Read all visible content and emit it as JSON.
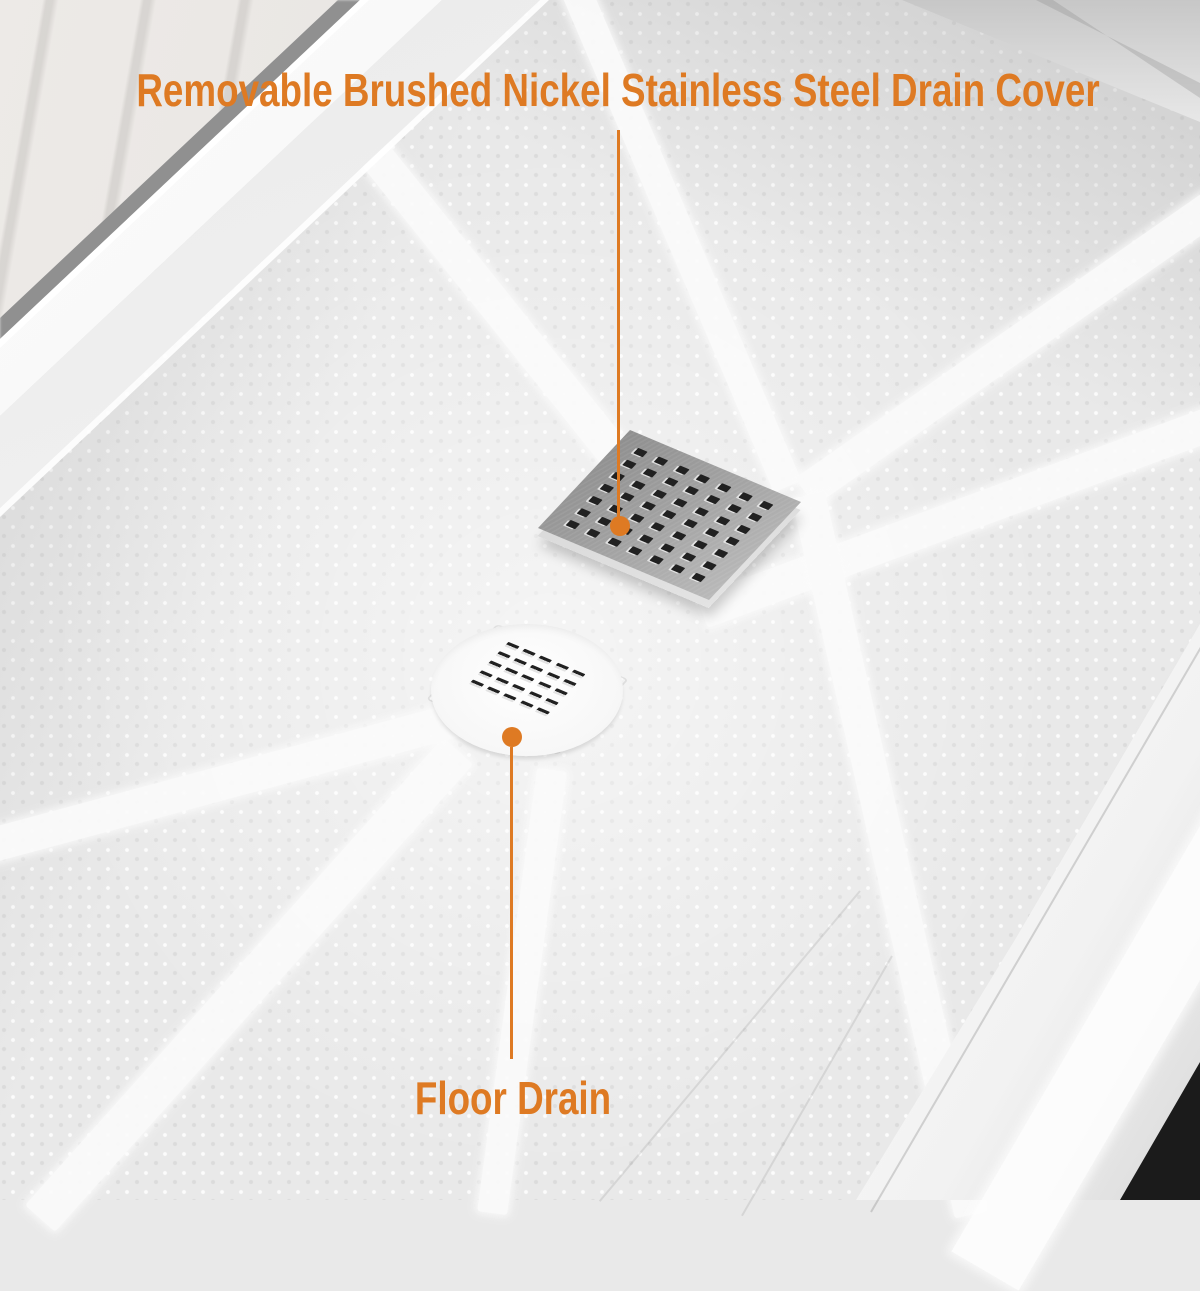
{
  "annotations": {
    "drain_cover_label": "Removable Brushed Nickel Stainless Steel Drain Cover",
    "floor_drain_label": "Floor Drain"
  },
  "colors": {
    "accent": "#DE7A23",
    "surface_base": "#E9E9E9",
    "channel_light": "#FBFBFB",
    "marble": "#E7E4E1",
    "plate_metal": "#A0A0A0",
    "plate_edge": "#D6D6D6",
    "hole_dark": "#212121",
    "dark_corner": "#1B1B1B"
  },
  "drain_cover": {
    "hole_rows": 7,
    "hole_cols": 7
  },
  "floor_drain": {
    "hole_rows": 5,
    "hole_cols": 5
  }
}
